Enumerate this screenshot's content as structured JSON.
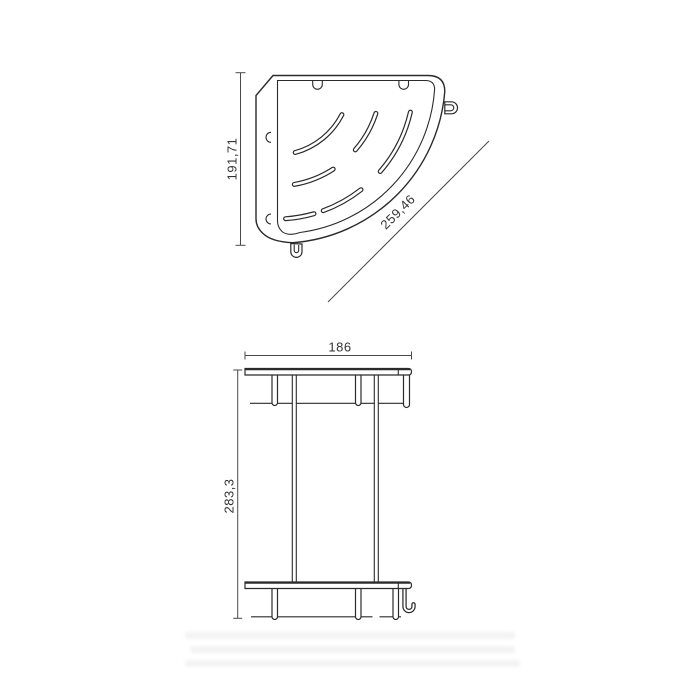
{
  "drawing": {
    "type": "technical-dimension-drawing",
    "subject": "corner shower basket shelf, two views",
    "background_color": "#ffffff",
    "line_color": "#2b2b2b",
    "dim_text_color": "#333333",
    "views": [
      {
        "id": "top-view",
        "description": "plan view of quarter-circle corner basket with drain slots, wall plate, side hook and bottom loop"
      },
      {
        "id": "front-view",
        "description": "front elevation of double-tier shelf with two rails, hanging posts and J-hook"
      }
    ],
    "dims": {
      "top_height": {
        "label": "191,71",
        "orientation": "vertical"
      },
      "top_diagonal": {
        "label": "259,46",
        "orientation": "diagonal-45deg"
      },
      "front_width": {
        "label": "186",
        "orientation": "horizontal"
      },
      "front_height": {
        "label": "283,3",
        "orientation": "vertical"
      }
    }
  }
}
